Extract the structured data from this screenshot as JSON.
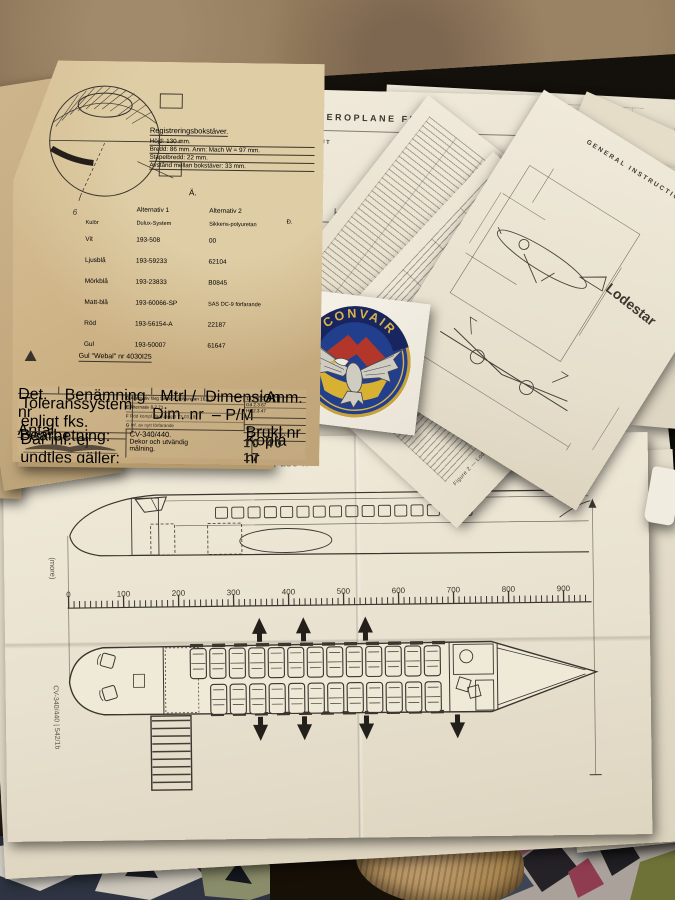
{
  "paint_doc": {
    "reg_title": "Registreringsbokstäver.",
    "reg_lines": [
      "Höjd: 130 mm.",
      "Bredd: 86 mm.  Anm: Mach W = 97 mm.",
      "Stapelbredd: 22 mm.",
      "Avstånd mellan bokstäver: 33 mm."
    ],
    "section_mark": "Ä.",
    "nose_label": "6",
    "color_table": {
      "col_color": "Kulör",
      "col_alt1": "Alternativ 1",
      "col_alt2": "Alternativ 2",
      "sub_alt1": "Dulux-System",
      "sub_alt2": "Sikkens-polyuretan",
      "sub_mark": "Ð.",
      "rows": [
        {
          "color": "Vit",
          "alt1": "193-508",
          "alt2": "00"
        },
        {
          "color": "Ljusblå",
          "alt1": "193-59233",
          "alt2": "62104"
        },
        {
          "color": "Mörkblå",
          "alt1": "193-23833",
          "alt2": "B0845"
        },
        {
          "color": "Matt-blå",
          "alt1": "193-60066-SP",
          "alt2": "SAS DC-9 förfarande"
        },
        {
          "color": "Röd",
          "alt1": "193-56154-A",
          "alt2": "22187"
        },
        {
          "color": "Gul",
          "alt1": "193-50007",
          "alt2": "61647"
        }
      ]
    },
    "webal_note": "Gul \"Webal\" nr 4030I25",
    "title_block": {
      "header_labels": [
        "Det. nr  Antal",
        "Benämning",
        "Mtrl / Dim. nr",
        "Dimension – P/M",
        "Anm."
      ],
      "tolerance_lines": [
        "Toleranssystem enligt fks.",
        "Där inf. ej undtles gäller:",
        "Borrn., Stansn.: Hål /13",
        "Svarvn.: Hål H 11, Axlar å 11",
        "Längdmått: J 13 – j 13"
      ],
      "revisions": [
        {
          "id": "D",
          "text": "Alternativ färg  Sikkens polyuretan",
          "date": "16.5.71"
        },
        {
          "id": "E",
          "text": "Alternativ",
          "date": "8.7.71"
        },
        {
          "id": "F",
          "text": "Röd kompl. färguppgift",
          "date": "73.03.19"
        },
        {
          "id": "G",
          "text": "Inf. av nytt förfarande",
          "date": ""
        }
      ],
      "sign_dates": [
        "13.1 3.67",
        "Gd  2.3.67",
        "Ho  2.3.47"
      ],
      "note_row": "Film med signums nr",
      "bearb_label": "Bearbetning:",
      "aircraft": "CV-340/440.",
      "description_1": "Dekor och utvändig",
      "description_2": "målning.",
      "brukl_label": "Brukl nr",
      "kopia_label": "Kopia nr",
      "to_label": "TO-",
      "drawing_number": "10 40 17"
    }
  },
  "flight_manual": {
    "title": "AEROPLANE FLIG",
    "subtitle": "W AIRCRAFT",
    "dims": {
      "length_top": "5781",
      "left1": "2670",
      "left2": "1577",
      "left3": "2413",
      "bottom": "765"
    }
  },
  "gi_sheet": {
    "header": "GENERAL INSTRUCTIONS",
    "brand": "Lodestar"
  },
  "fig2_sheet": {
    "caption": "Figure 2 — Lodestar Basic Dimensions"
  },
  "badge": {
    "text": "CONVAIR"
  },
  "seating": {
    "caption": "56 Pass ..",
    "ruler_labels": [
      "0",
      "100",
      "200",
      "300",
      "400",
      "500",
      "600",
      "700",
      "800",
      "900"
    ],
    "side_note": "(more)",
    "side_code": "CV-340/440 | 542/1b",
    "right_text": "ND EQUIPMENT",
    "right_text_2": "(Cont'd)"
  },
  "colors": {
    "paper_tan": "#d2b88e",
    "paper_white": "#ebe5d6",
    "ink": "#35302a",
    "badge_navy": "#223f8e",
    "badge_gold": "#c9a23a",
    "badge_red": "#b23629",
    "badge_yellow": "#d8b133",
    "table_dark": "#15100b",
    "floor_brown": "#8d7459"
  }
}
